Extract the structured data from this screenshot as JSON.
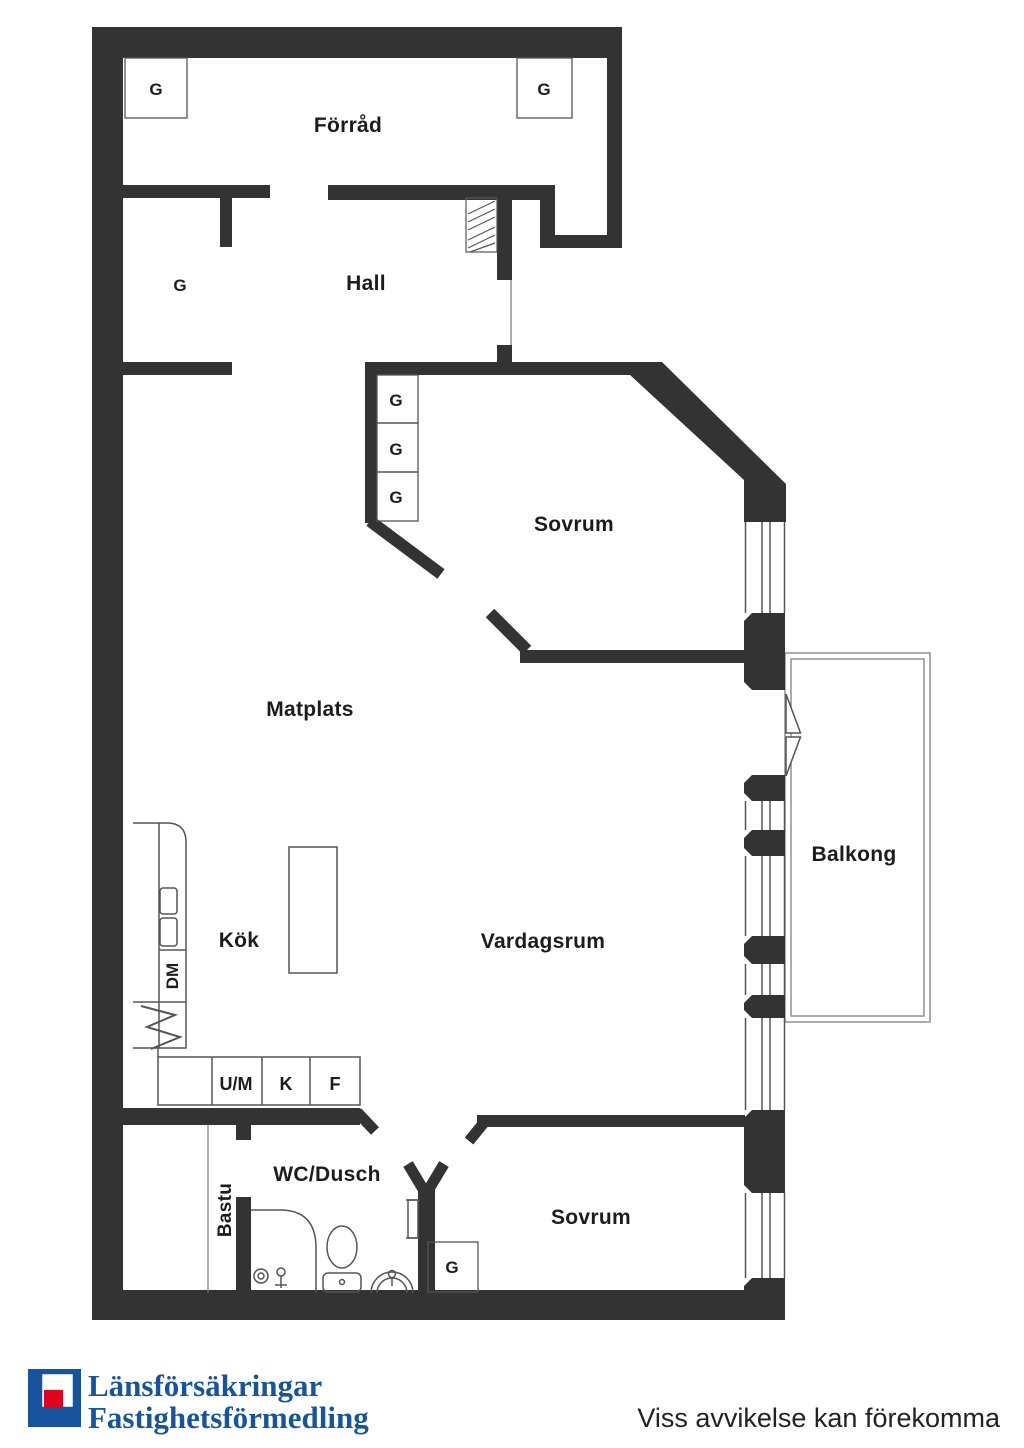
{
  "plan": {
    "rooms": {
      "forrad": "Förråd",
      "hall": "Hall",
      "sovrum_top": "Sovrum",
      "matplats": "Matplats",
      "kok": "Kök",
      "vardagsrum": "Vardagsrum",
      "balkong": "Balkong",
      "wc_dusch": "WC/Dusch",
      "bastu": "Bastu",
      "sovrum_bottom": "Sovrum"
    },
    "closet_label": "G",
    "appliances": {
      "dm": "DM",
      "um": "U/M",
      "k": "K",
      "f": "F"
    }
  },
  "footer": {
    "logo_line1": "Länsförsäkringar",
    "logo_line2": "Fastighetsförmedling",
    "disclaimer": "Viss avvikelse kan förekomma"
  },
  "colors": {
    "wall": "#333333",
    "thin_line": "#555555",
    "label": "#1c1c1c",
    "logo_blue": "#17549F",
    "logo_red": "#E2001A"
  }
}
